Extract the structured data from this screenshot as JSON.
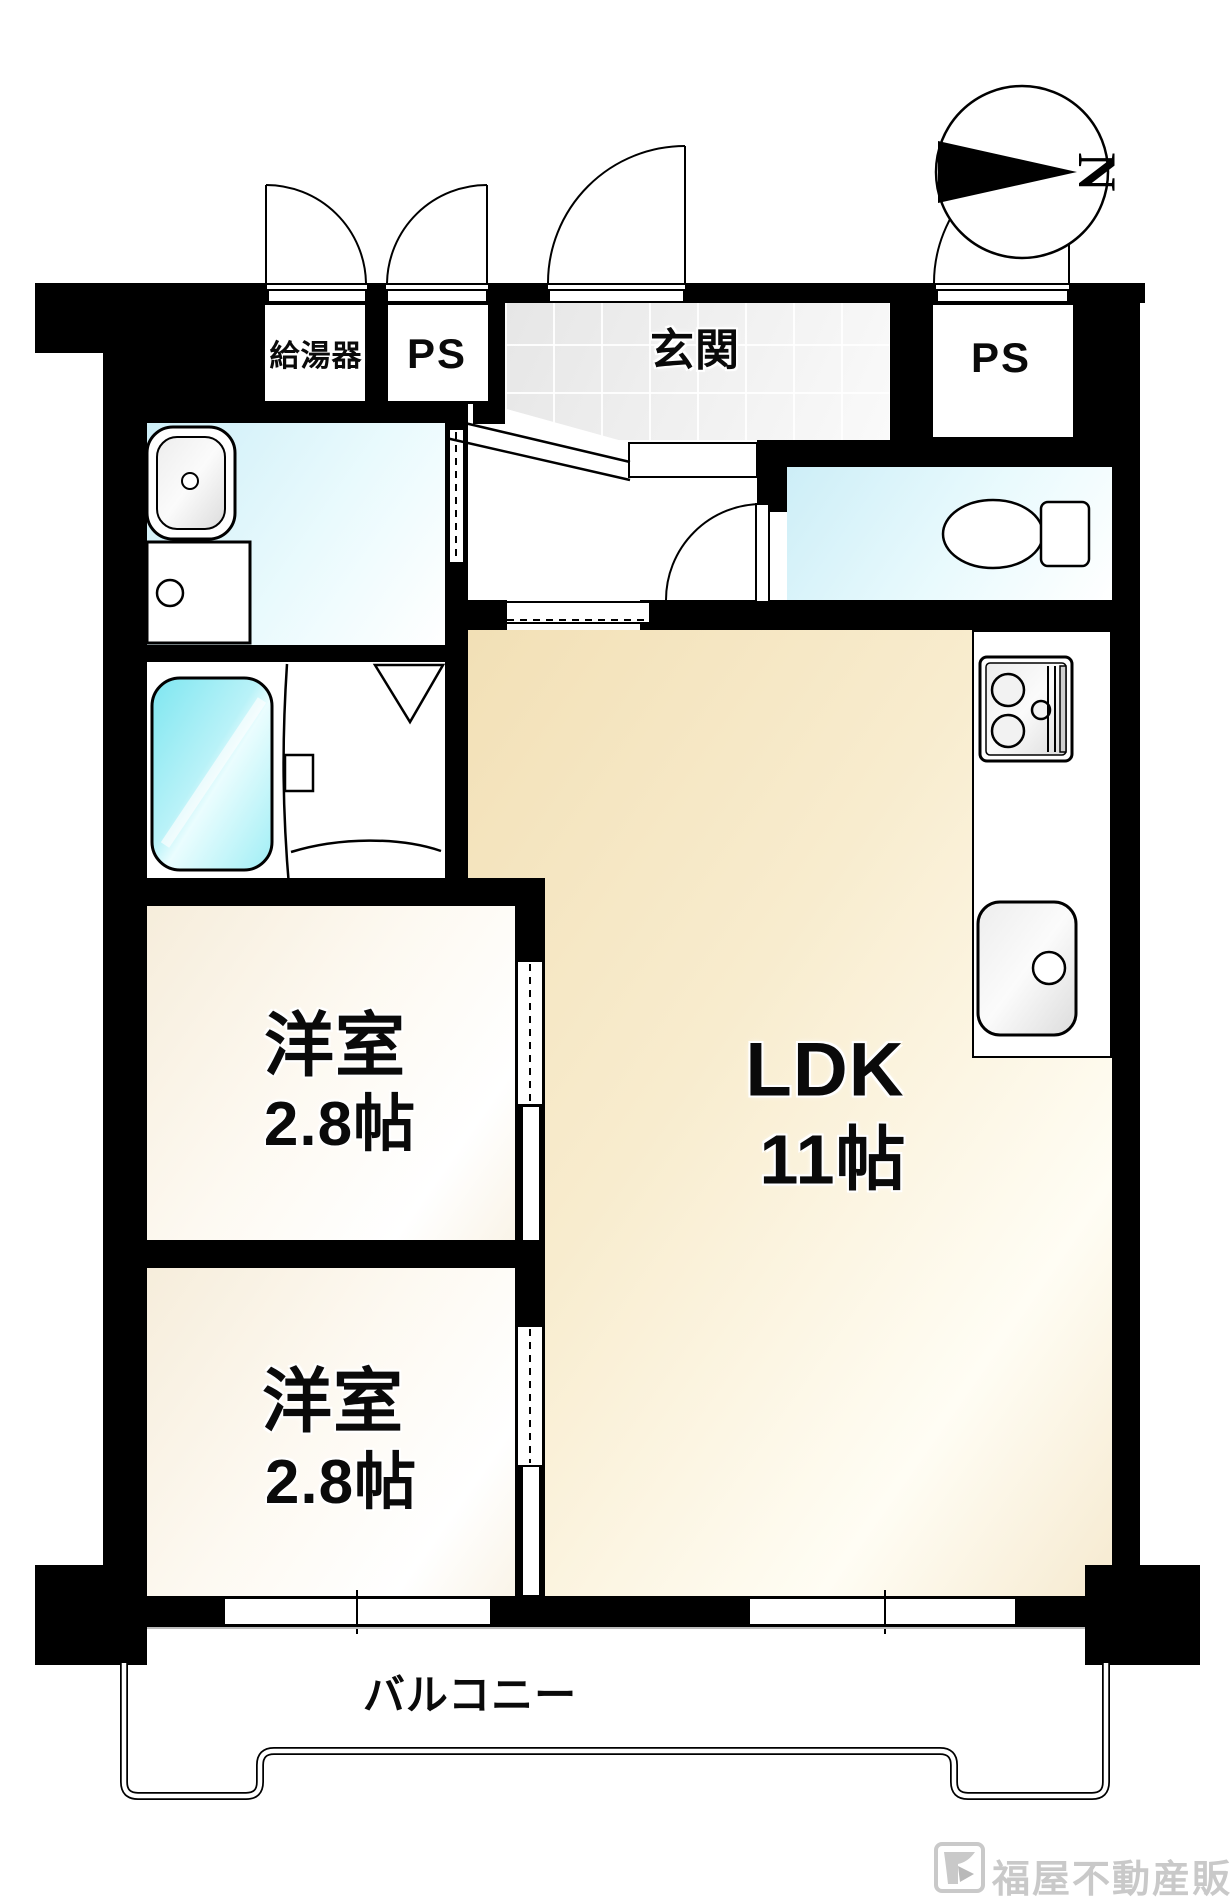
{
  "compass": {
    "label": "N"
  },
  "labels": {
    "water_heater": "給湯器",
    "ps_top_left": "PS",
    "ps_top_right": "PS",
    "entrance": "玄関",
    "ldk_name": "LDK",
    "ldk_size": "11帖",
    "bedroom_upper_name": "洋室",
    "bedroom_upper_size": "2.8帖",
    "bedroom_lower_name": "洋室",
    "bedroom_lower_size": "2.8帖",
    "balcony": "バルコニー"
  },
  "branding": {
    "company": "福屋不動産販売"
  },
  "colors": {
    "wall": "#000000",
    "ldk_floor": "#f2e0b6",
    "bedroom_floor": "#f6eddb",
    "wet_area_floor": "#cdeef7",
    "bathtub": "#86e7f1",
    "entrance_tile": "#e6e6e6",
    "logo_gray": "#c9c9c9"
  }
}
